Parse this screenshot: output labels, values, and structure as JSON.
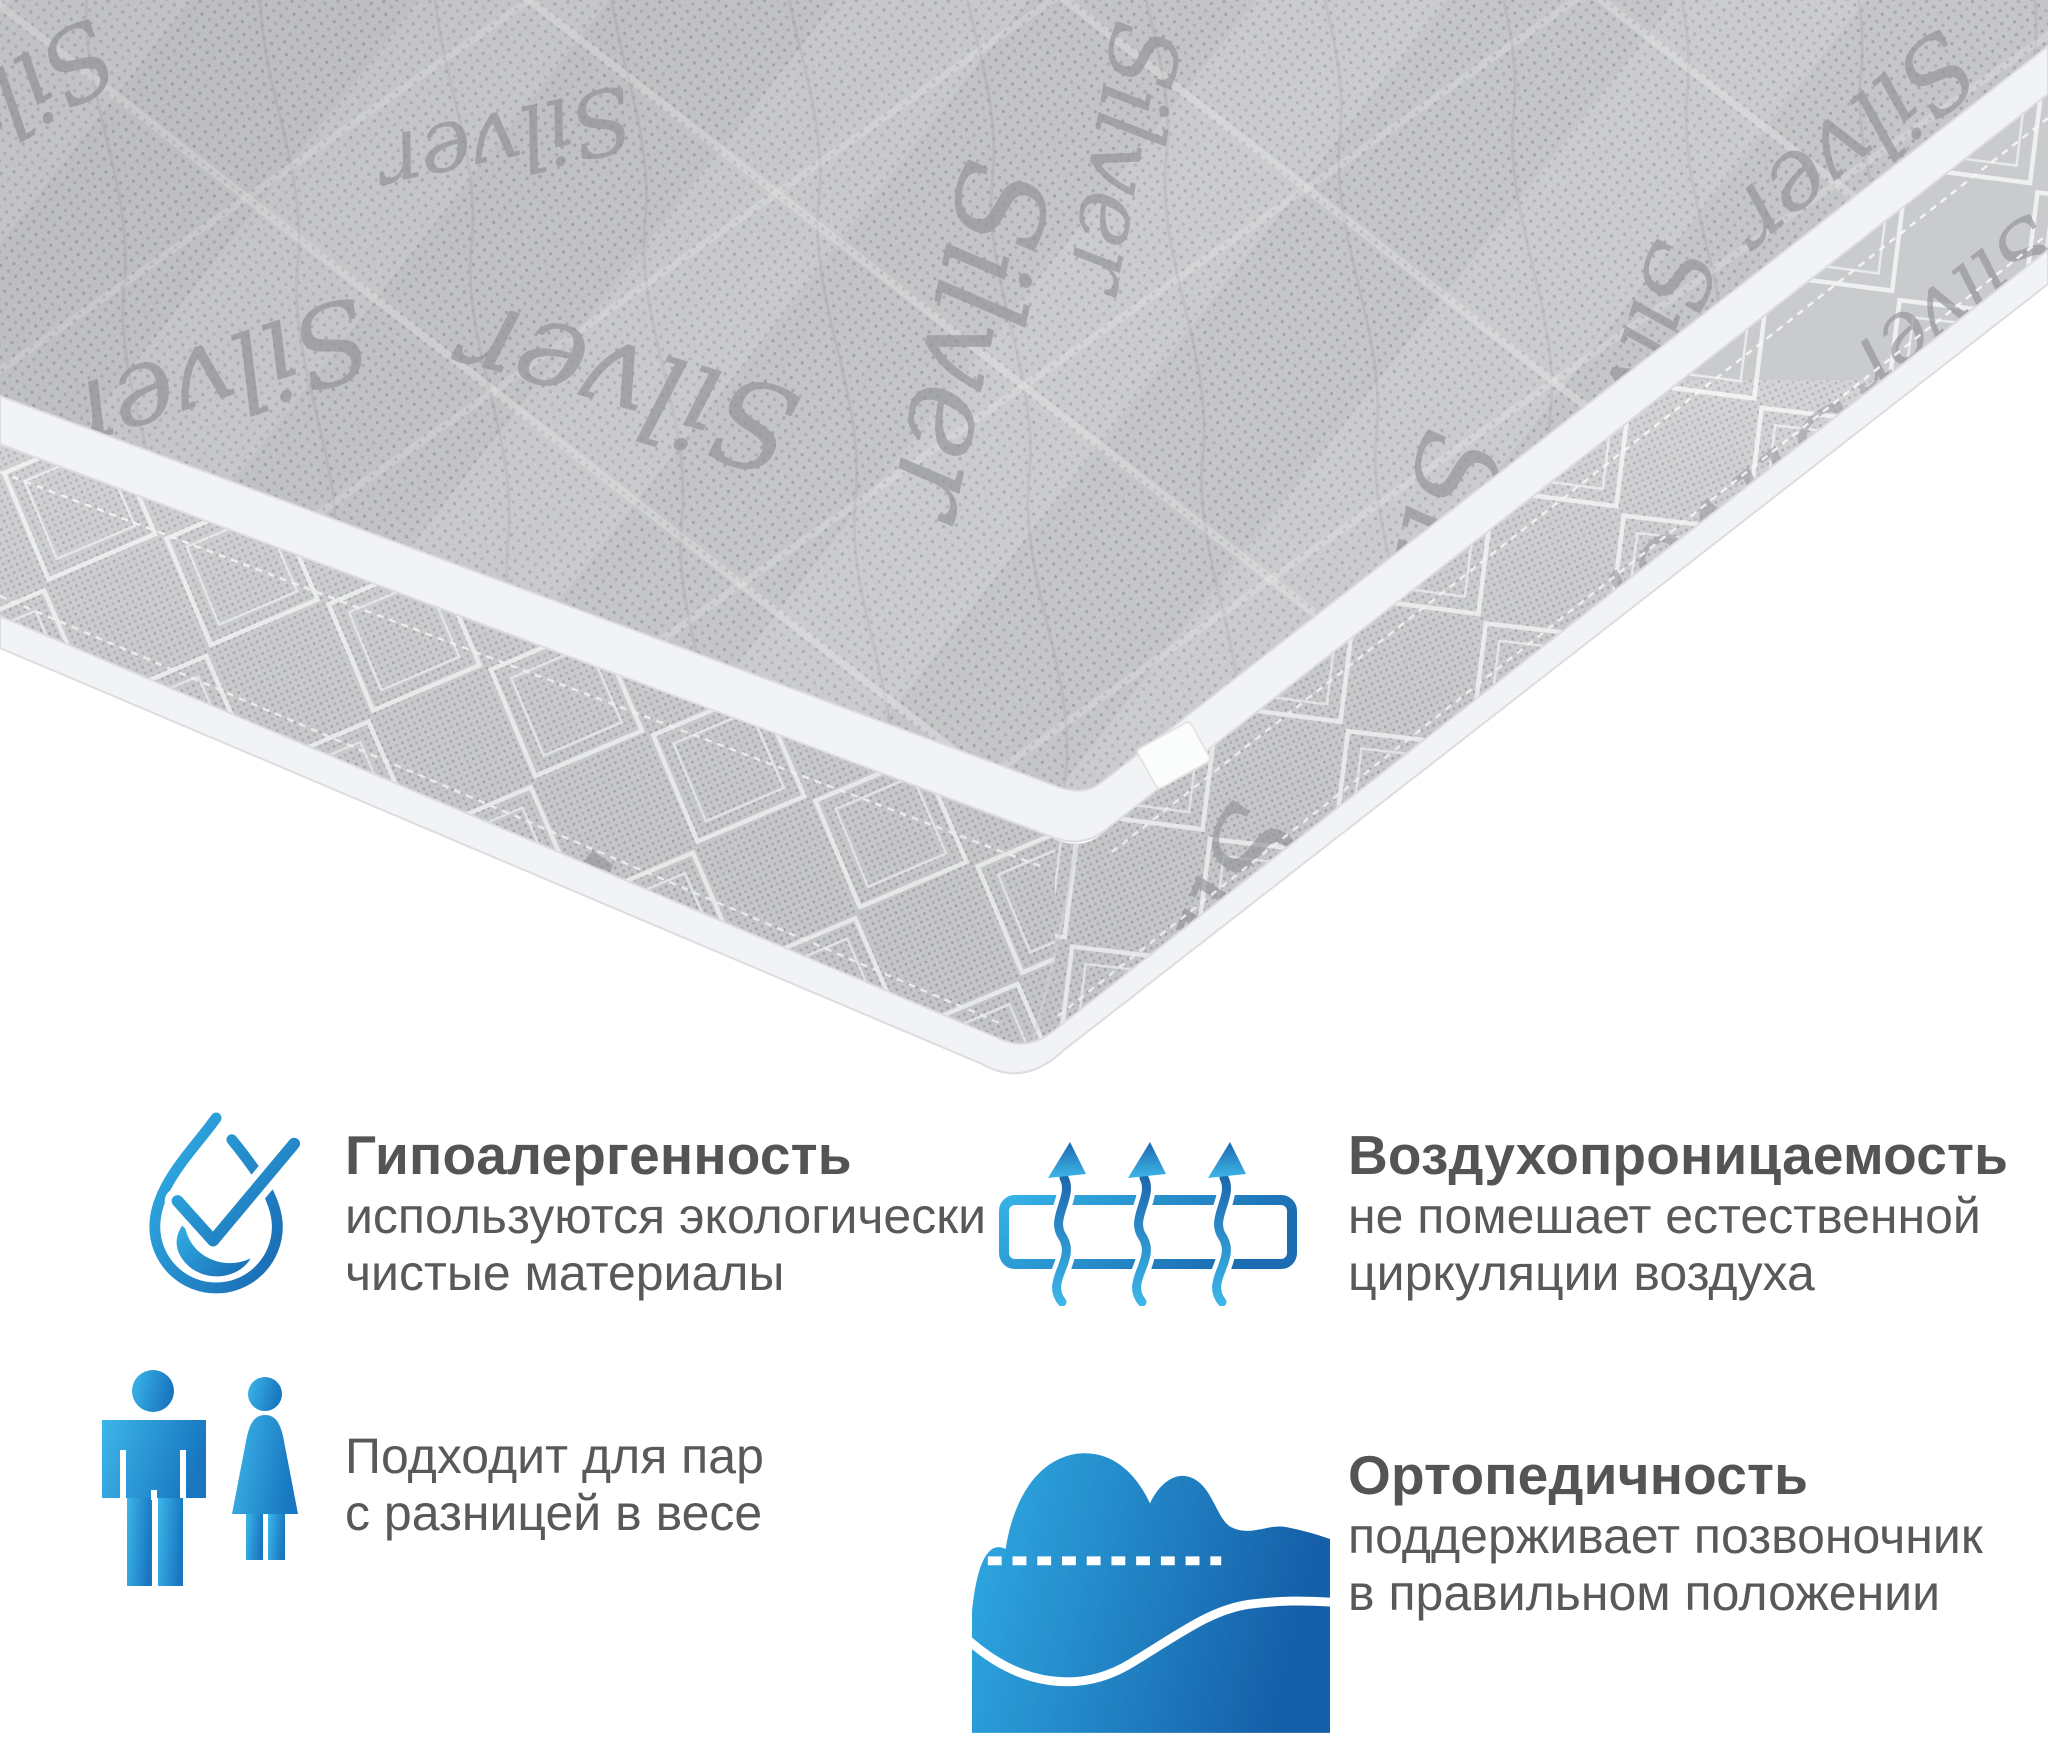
{
  "canvas": {
    "width": 2048,
    "height": 1758,
    "background": "#ffffff"
  },
  "mattress": {
    "brand_script": "Silver",
    "colors": {
      "fabric_top": "#c5c6c8",
      "fabric_side": "#cacbcd",
      "piping": "#f2f3f5",
      "stitch": "#eef0f1",
      "script_gray": "#97989c"
    }
  },
  "accent": {
    "blue_light": "#29abe2",
    "blue_dark": "#1b75bc"
  },
  "text": {
    "title_color": "#535456",
    "body_color": "#58595b"
  },
  "features": [
    {
      "id": "hypoallergenic",
      "icon": "water-drop-check-icon",
      "title": "Гипоалергенность",
      "body": "используются экологически\nчистые материалы"
    },
    {
      "id": "breathability",
      "icon": "airflow-through-layer-icon",
      "title": "Воздухопроницаемость",
      "body": "не помешает естественной\nциркуляции воздуха"
    },
    {
      "id": "couples",
      "icon": "man-and-woman-icon",
      "title": "",
      "body": "Подходит для пар\nс разницей в весе"
    },
    {
      "id": "orthopedic",
      "icon": "body-on-mattress-icon",
      "title": "Ортопедичность",
      "body": "поддерживает позвоночник\nв правильном положении"
    }
  ]
}
